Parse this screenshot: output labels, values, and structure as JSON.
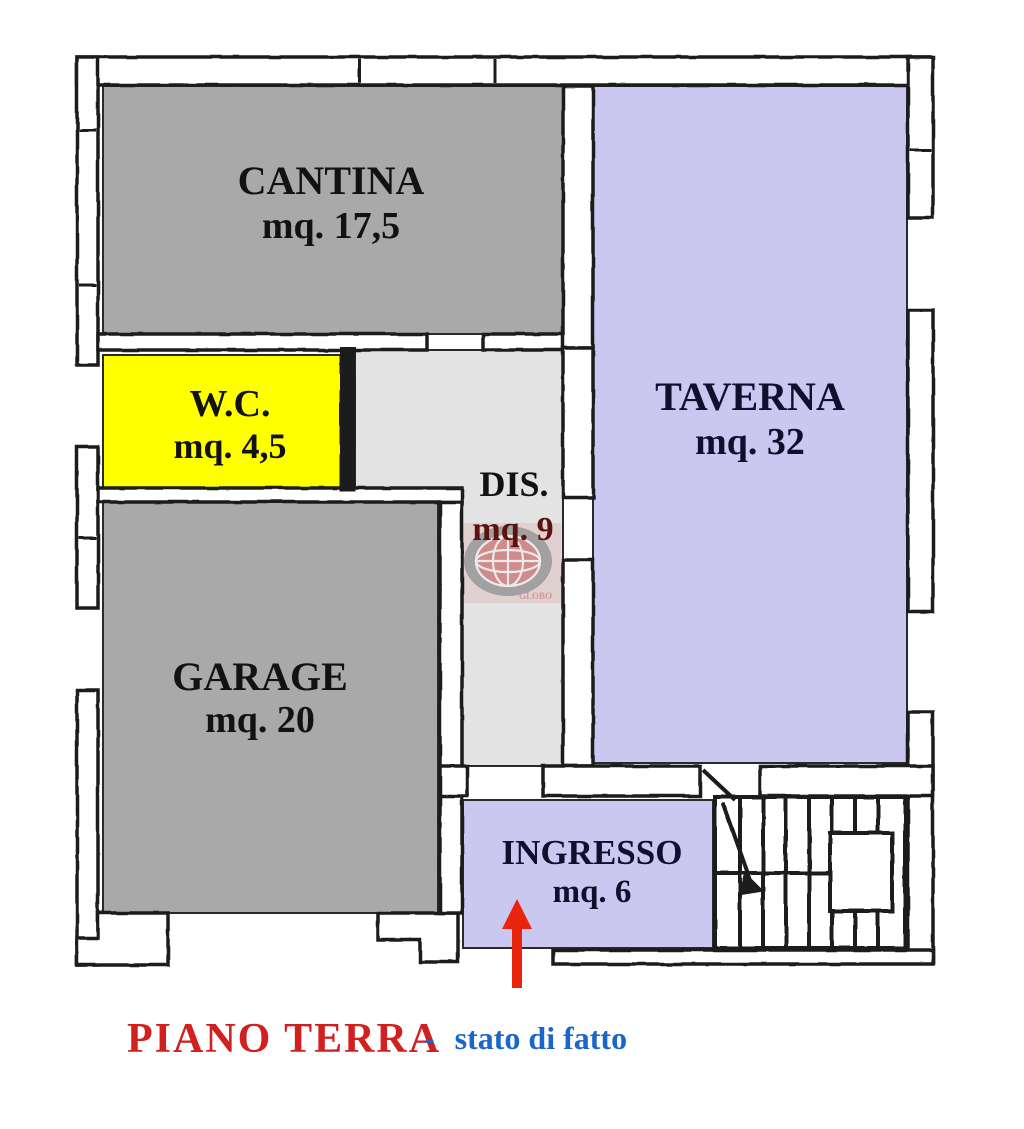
{
  "plan": {
    "rooms": [
      {
        "id": "cantina",
        "name": "CANTINA",
        "area": "mq. 17,5",
        "fill": "#a9a9a9",
        "label_color": "#121212"
      },
      {
        "id": "taverna",
        "name": "TAVERNA",
        "area": "mq. 32",
        "fill": "#cac8f0",
        "label_color": "#10102e"
      },
      {
        "id": "wc",
        "name": "W.C.",
        "area": "mq. 4,5",
        "fill": "#ffff00",
        "label_color": "#121212"
      },
      {
        "id": "dis",
        "name": "DIS.",
        "area": "mq. 9",
        "fill": "#e3e3e3",
        "label_color": "#121212",
        "area_color": "#5c120f"
      },
      {
        "id": "garage",
        "name": "GARAGE",
        "area": "mq. 20",
        "fill": "#a9a9a9",
        "label_color": "#121212"
      },
      {
        "id": "ingresso",
        "name": "INGRESSO",
        "area": "mq. 6",
        "fill": "#cac8f0",
        "label_color": "#10102e"
      }
    ],
    "walls_color": "#1c1c1c",
    "entrance_arrow_color": "#e8250c"
  },
  "caption": {
    "floor_label": "PIANO TERRA",
    "floor_color": "#d02020",
    "separator": "-",
    "status_label": "stato di fatto",
    "status_color": "#1b66c9"
  },
  "watermark": {
    "text": "GLOBO",
    "accent": "#c03a3a"
  }
}
